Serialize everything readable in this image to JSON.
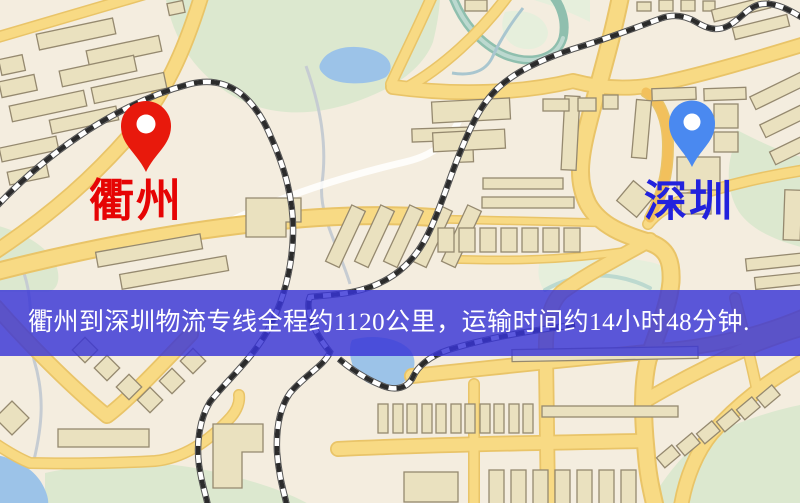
{
  "banner": {
    "text": "衢州到深圳物流专线全程约1120公里，运输时间约14小时48分钟."
  },
  "markers": {
    "origin": {
      "label": "衢州"
    },
    "destination": {
      "label": "深圳"
    }
  },
  "map_legend": {
    "type": "static-road-map",
    "features": [
      "roads",
      "railways",
      "parks",
      "lakes",
      "buildings"
    ]
  },
  "colors": {
    "band-bg": "rgba(56,52,215,0.82)",
    "band-text": "#ffffff",
    "pin-red": "#e8190c",
    "pin-blue": "#4a89f0",
    "label-red": "#e60404",
    "label-blue": "#2222dd",
    "bg": "#f4eddf",
    "road-fill": "#f8da84",
    "road-casing": "#e9c468",
    "road-orange": "#f2c05c",
    "park": "#dce8cf",
    "water": "#9cc3e8",
    "water-teal": "#8fbfae",
    "building": "#eae1bf",
    "building-edge": "#95896f",
    "rail-dash": "#2b2b2b"
  }
}
